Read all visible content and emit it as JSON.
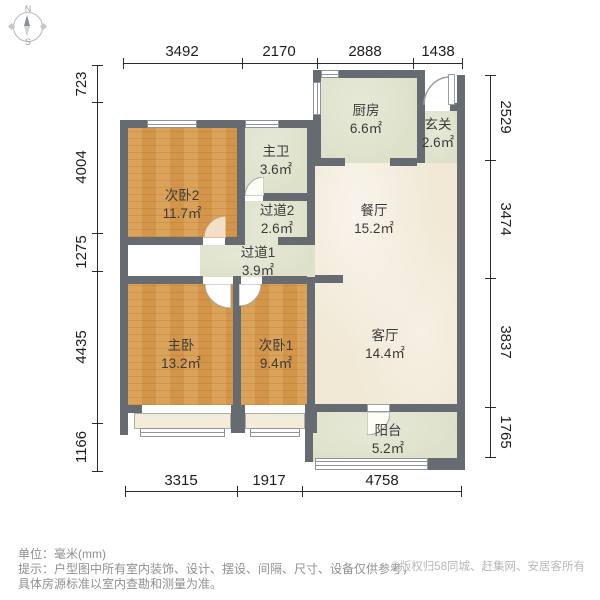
{
  "compass": {
    "north_label": "N",
    "south_label": "S"
  },
  "dimensions": {
    "top": [
      "3492",
      "2170",
      "2888",
      "1438"
    ],
    "left": [
      "723",
      "4004",
      "1275",
      "4435",
      "1166"
    ],
    "right": [
      "2529",
      "3474",
      "3837",
      "1765"
    ],
    "bottom": [
      "3315",
      "1917",
      "4758"
    ]
  },
  "rooms": [
    {
      "name": "次卧2",
      "area": "11.7㎡"
    },
    {
      "name": "主卫",
      "area": "3.6㎡"
    },
    {
      "name": "过道2",
      "area": "2.6㎡"
    },
    {
      "name": "过道1",
      "area": "3.9㎡"
    },
    {
      "name": "厨房",
      "area": "6.6㎡"
    },
    {
      "name": "玄关",
      "area": "2.6㎡"
    },
    {
      "name": "餐厅",
      "area": "15.2㎡"
    },
    {
      "name": "主卧",
      "area": "13.2㎡"
    },
    {
      "name": "次卧1",
      "area": "9.4㎡"
    },
    {
      "name": "客厅",
      "area": "14.4㎡"
    },
    {
      "name": "阳台",
      "area": "5.2㎡"
    }
  ],
  "footer": {
    "unit_label": "单位：毫米(mm)",
    "tip_line1": "提示：户型图中所有室内装饰、设计、摆设、间隔、尺寸、设备仅供参考，",
    "tip_line2": "具体房源标准以室内查勘和测量为准。",
    "copyright": "©版权归58同城、赶集网、安居客所有"
  },
  "colors": {
    "wall": "#666a71",
    "wood_floor": "#d79a4e",
    "tile_floor": "#dee1ca",
    "marble_floor": "#f1e8d5",
    "bay_window": "#f3ecd9"
  }
}
